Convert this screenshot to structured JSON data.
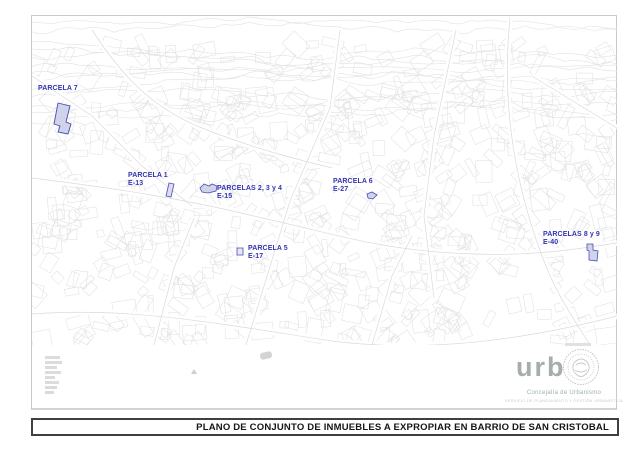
{
  "document": {
    "title": "PLANO DE CONJUNTO DE INMUEBLES A EXPROPIAR EN BARRIO DE SAN CRISTOBAL"
  },
  "map": {
    "labels": [
      {
        "name": "PARCELA 7",
        "code": ""
      },
      {
        "name": "PARCELA 1",
        "code": "E-13"
      },
      {
        "name": "PARCELAS 2, 3 y 4",
        "code": "E-15"
      },
      {
        "name": "PARCELA 6",
        "code": "E-27"
      },
      {
        "name": "PARCELA 5",
        "code": "E-17"
      },
      {
        "name": "PARCELAS 8 y 9",
        "code": "E-40"
      }
    ],
    "label_color": "#3434b2",
    "parcel_fill": "#c8cce8",
    "parcel_stroke": "#4b4bb4"
  },
  "footer": {
    "logo_wordmark": "urb",
    "department": "Concejalía de Urbanismo",
    "service_line": "SERVICIO DE PLANEAMIENTO Y GESTIÓN URBANÍSTICA"
  }
}
